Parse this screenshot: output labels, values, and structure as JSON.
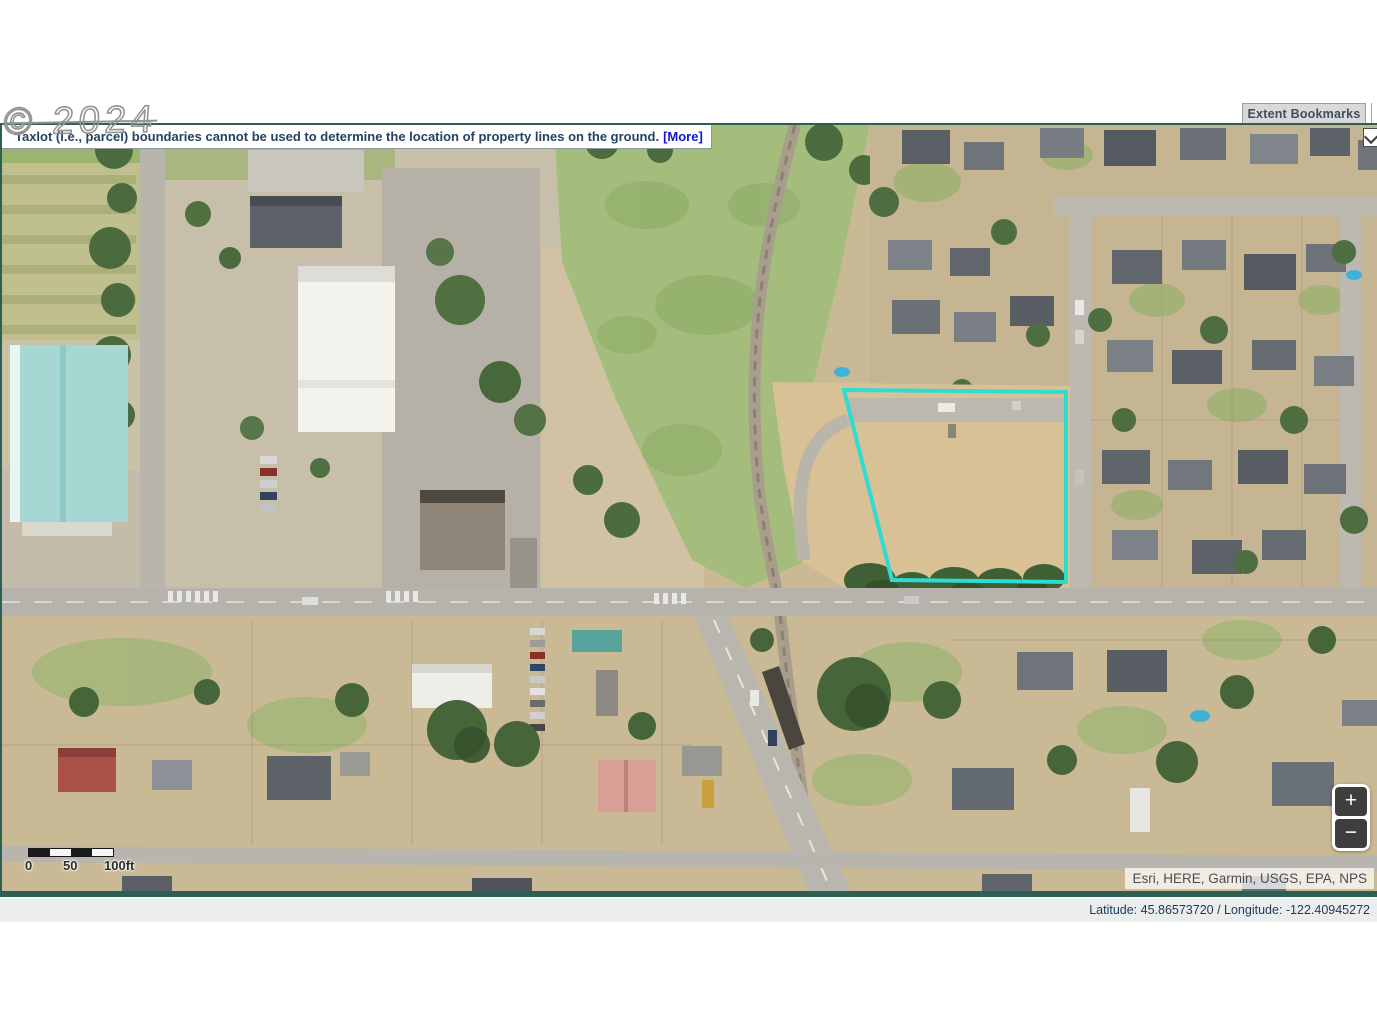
{
  "watermark": {
    "text": "© 2024"
  },
  "disclaimer": {
    "text": "Taxlot (i.e., parcel) boundaries cannot be used to determine the location of property lines on the ground.",
    "more_label": "[More]"
  },
  "header": {
    "extent_bookmarks_label": "Extent Bookmarks"
  },
  "map": {
    "scalebar": {
      "labels": [
        "0",
        "50",
        "100ft"
      ]
    },
    "zoom_control": {
      "zoom_in_label": "+",
      "zoom_out_label": "−"
    },
    "attribution": "Esri, HERE, Garmin, USGS, EPA, NPS",
    "parcel_outline_color": "#2edcd2"
  },
  "statusbar": {
    "coordinates": "Latitude: 45.86573720 / Longitude: -122.40945272"
  }
}
